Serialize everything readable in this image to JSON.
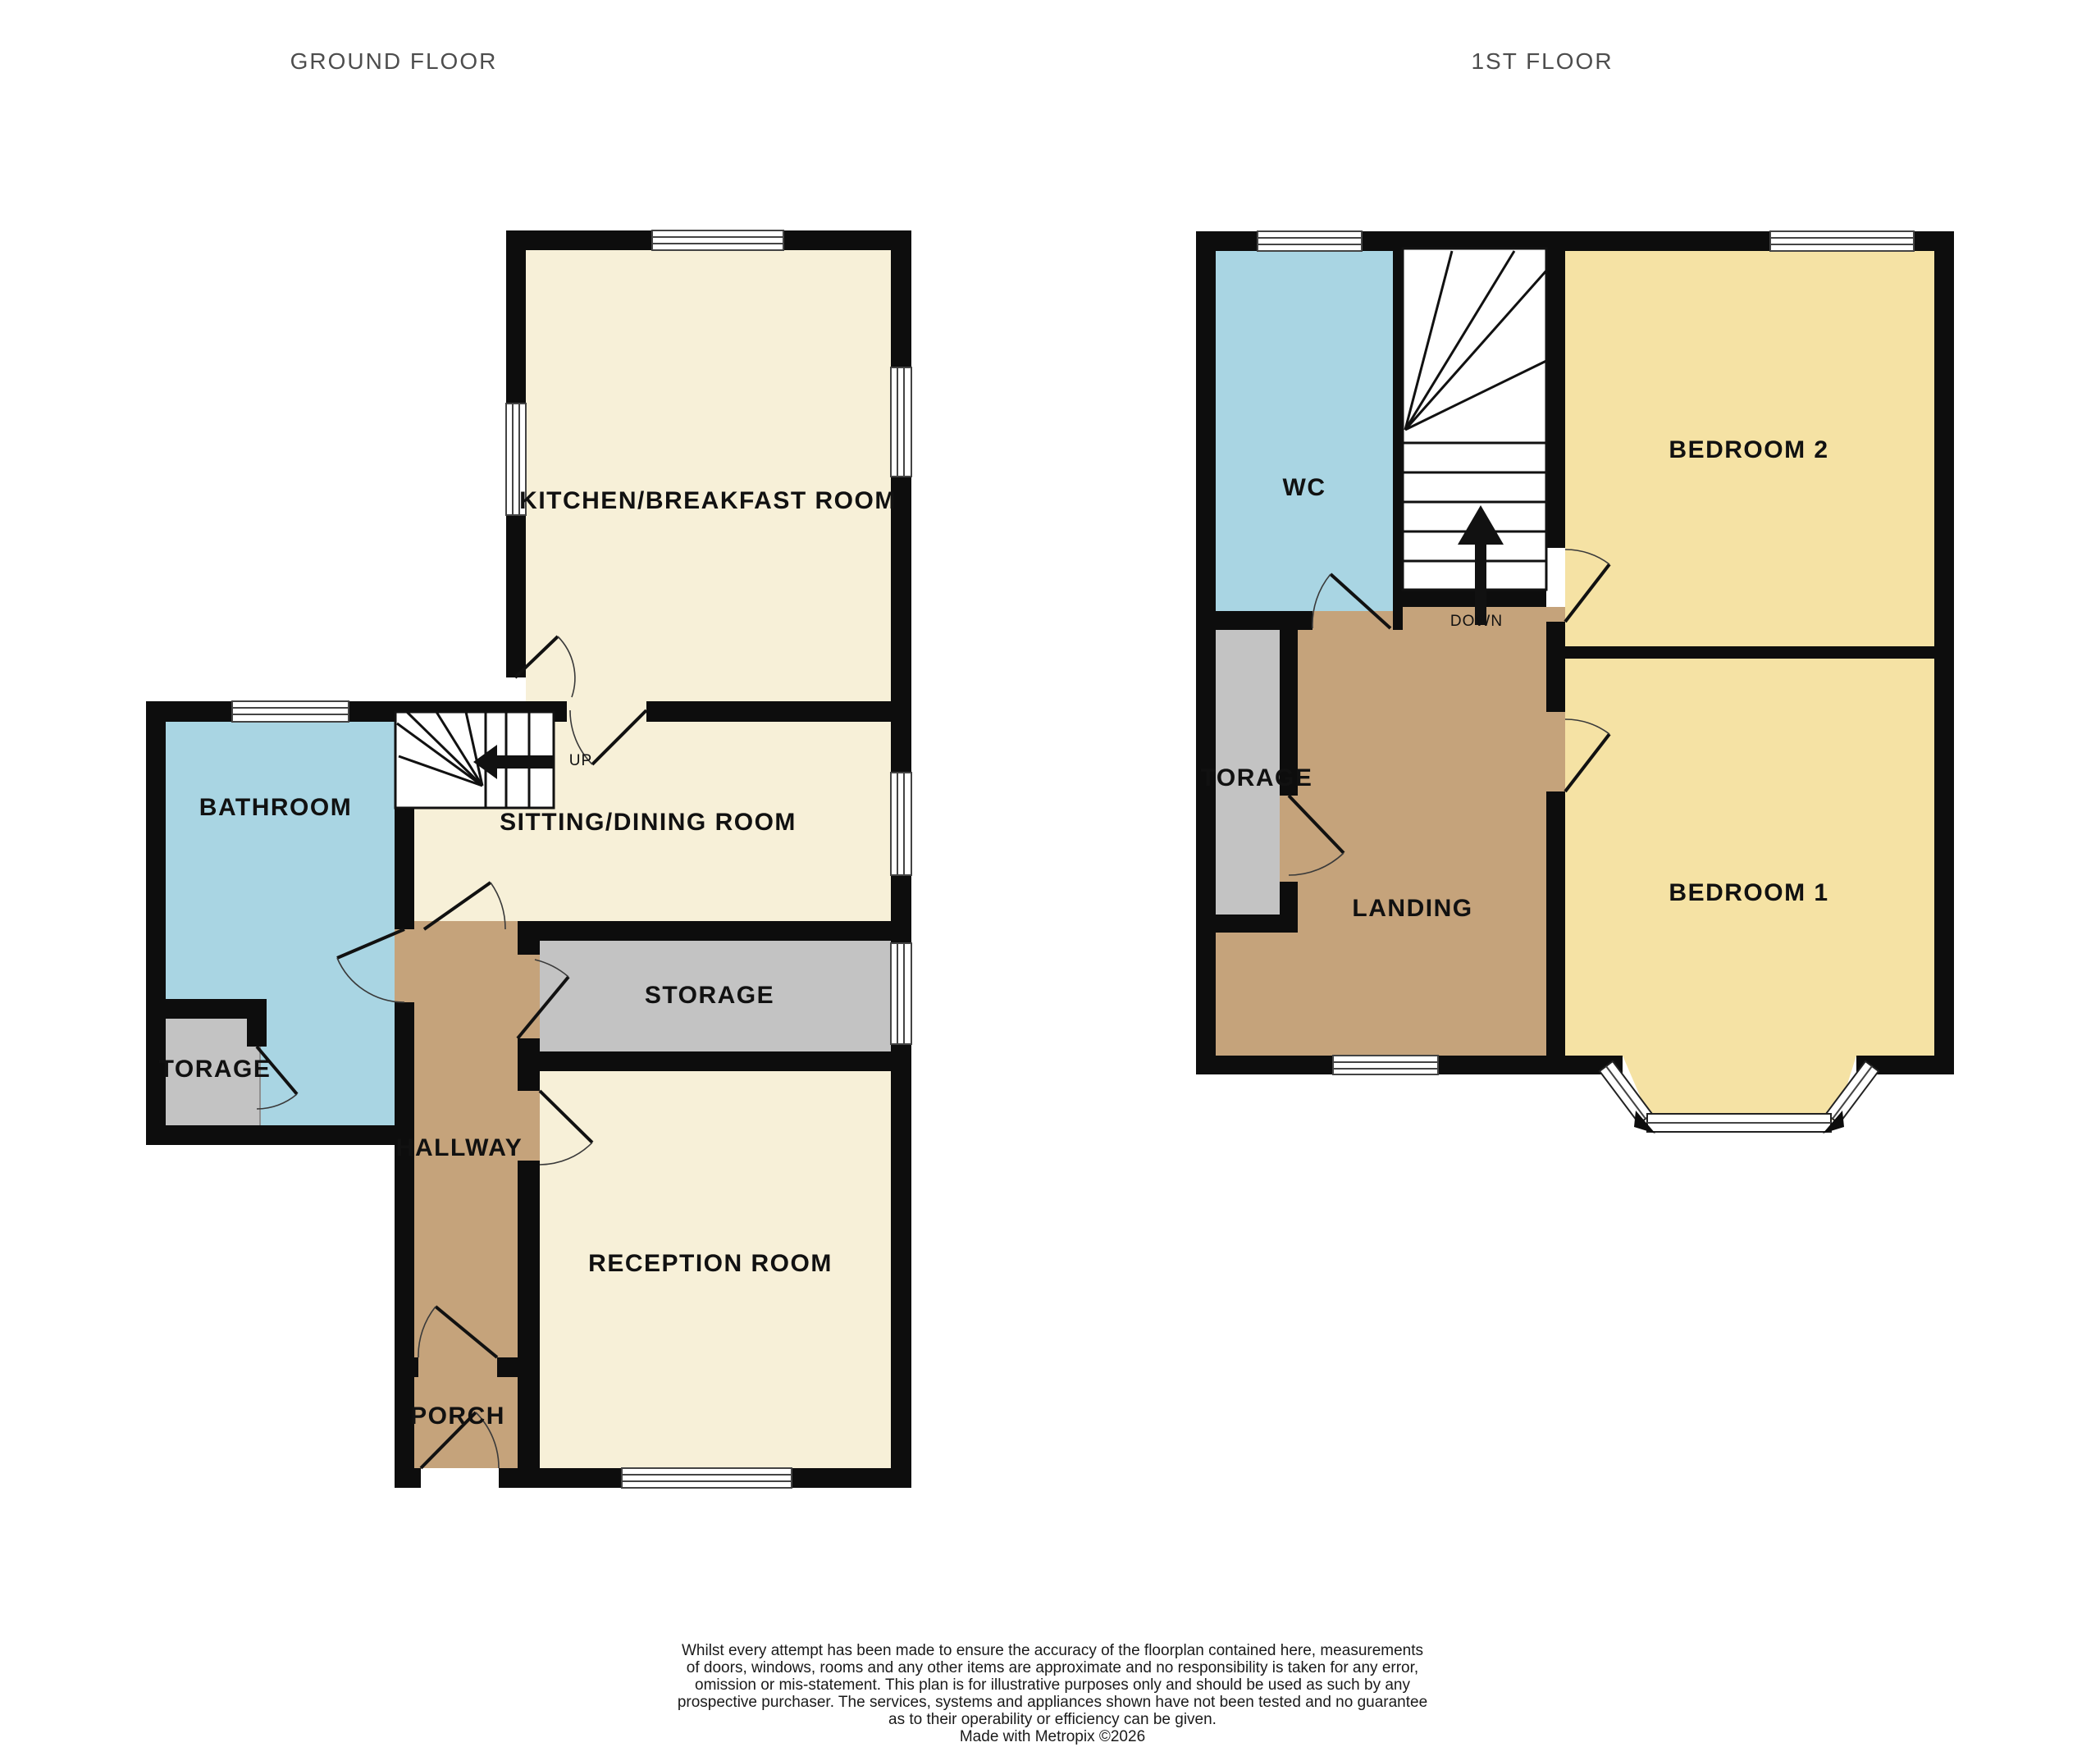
{
  "titles": {
    "ground": "GROUND FLOOR",
    "first": "1ST FLOOR"
  },
  "ground": {
    "kitchen": "KITCHEN/BREAKFAST ROOM",
    "sitting": "SITTING/DINING ROOM",
    "bathroom": "BATHROOM",
    "storage_small": "TORAGE",
    "storage": "STORAGE",
    "hallway": "HALLWAY",
    "reception": "RECEPTION ROOM",
    "porch": "PORCH",
    "stairs_direction": "UP"
  },
  "first": {
    "wc": "WC",
    "bedroom2": "BEDROOM 2",
    "bedroom1": "BEDROOM 1",
    "landing": "LANDING",
    "storage": "TORAGE",
    "stairs_direction": "DOWN"
  },
  "colors": {
    "wall": "#0d0d0d",
    "living": "#f7f0d8",
    "bedroom": "#f5e2a4",
    "wet": "#a9d5e3",
    "circulation": "#c5a37b",
    "storage": "#c3c3c3",
    "window": "#ffffff",
    "stairs": "#ffffff",
    "title_text": "#4d4d4d",
    "label_text": "#111111"
  },
  "disclaimer": {
    "lines": [
      "Whilst every attempt has been made to ensure the accuracy of the floorplan contained here, measurements",
      "of doors, windows, rooms and any other items are approximate and no responsibility is taken for any error,",
      "omission or mis-statement. This plan is for illustrative purposes only and should be used as such by any",
      "prospective purchaser. The services, systems and appliances shown have not been tested and no guarantee",
      "as to their operability or efficiency can be given.",
      "Made with Metropix ©2026"
    ]
  }
}
